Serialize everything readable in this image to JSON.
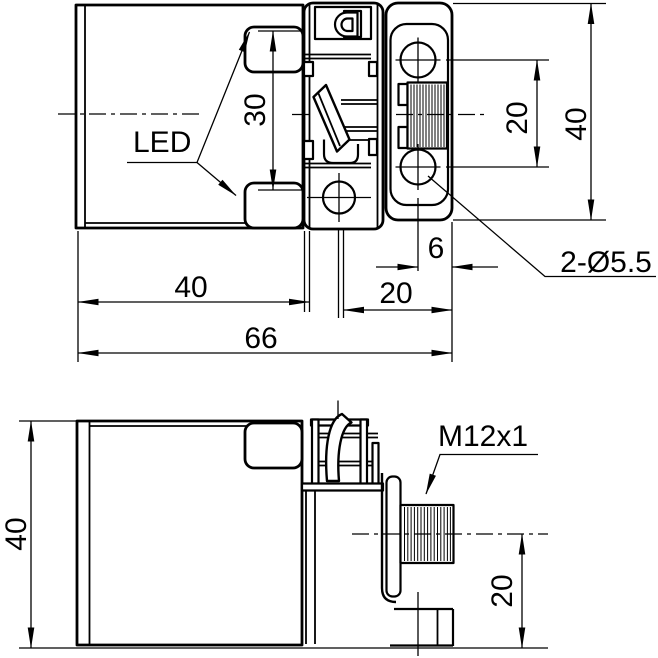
{
  "colors": {
    "line": "#000000",
    "background": "#ffffff"
  },
  "top_view": {
    "led_label": "LED",
    "dim_led_spacing": "30",
    "dim_head_length": "40",
    "dim_overall_length": "66",
    "dim_bracket_length": "20",
    "dim_hole_edge_offset": "6",
    "holes_callout": "2-Ø5.5",
    "dim_hole_spacing": "20",
    "dim_bracket_height": "40"
  },
  "side_view": {
    "dim_height": "40",
    "connector_callout": "M12x1",
    "dim_connector_height": "20"
  }
}
